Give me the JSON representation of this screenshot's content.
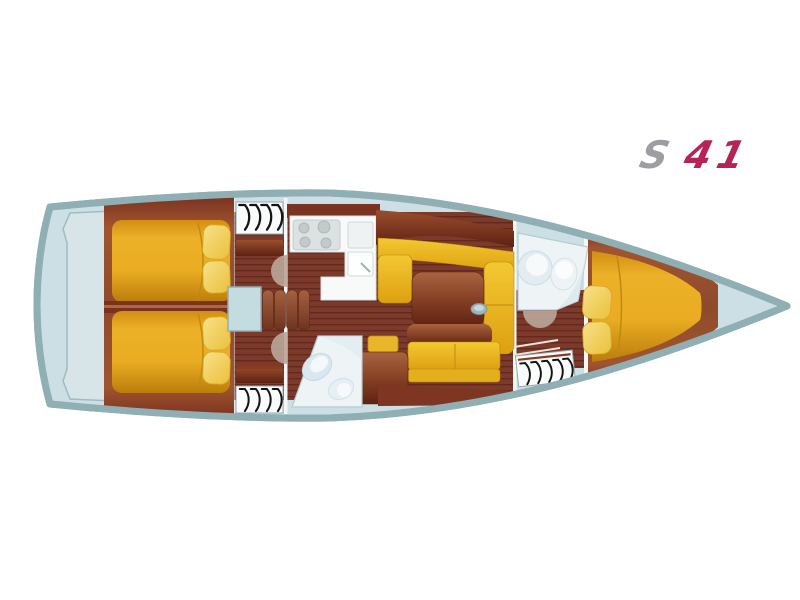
{
  "logo": {
    "series_letter": "S",
    "model_number": "41",
    "series_color": "#9c9ea1",
    "model_color": "#b62457"
  },
  "plan": {
    "hull_outline_color": "#8fafb4",
    "deck_color": "#ccdfe4",
    "transom_color": "#d7e5e9",
    "floor_color": "#7d3929",
    "floor_stripe_color": "#63291c",
    "wood_trim_color": "#96512f",
    "berth_color": "#e6a91f",
    "pillow_color": "#f3d468",
    "settee_color": "#efc02c",
    "table_color": "#8a4427",
    "counter_color": "#f8fafa",
    "stove_color": "#dce2e2",
    "head_color": "#eef4f6",
    "fixture_color": "#dce9ef",
    "door_color": "#b9a597",
    "hanger_color": "#141414",
    "engine_box_color": "#c4dbe0"
  },
  "wardrobes": {
    "aft_port_hangers": 4,
    "aft_starboard_hangers": 4,
    "forward_hangers": 5
  },
  "icons": {
    "hanger": "hanger-icon"
  }
}
